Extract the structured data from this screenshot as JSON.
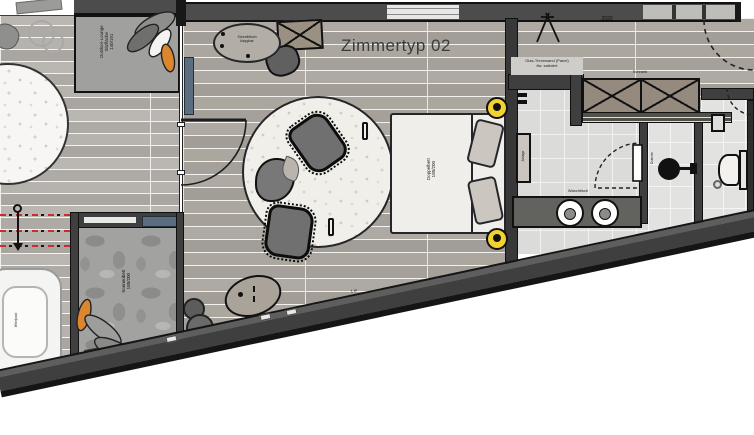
{
  "plan": {
    "title": "Zimmertyp 02",
    "labels": {
      "outdoor_lounge": [
        "Outdoor-Lounge",
        "Sitzfläche",
        "140/191"
      ],
      "sun_bed": [
        "Sonnenbett",
        "180/200"
      ],
      "whirlpool": "Whirlpool",
      "bed": [
        "Doppelbett",
        "180/200"
      ],
      "desk": [
        "Schreibtisch",
        "klappbar"
      ],
      "washbasin": "Waschtisch",
      "shelf": "Ablage",
      "shower": "Dusche",
      "wardrobe": "Schrank",
      "glass_note": [
        "Glas-Trennwand (Panel)",
        "tlw. satiniert"
      ],
      "dimension_top": "2020",
      "scale_note": "1 m"
    },
    "colors": {
      "wall_dark": "#3f3f3f",
      "accent_orange": "#dd8630",
      "lamp_yellow": "#f2d231",
      "glass_blue": "#5c6d7f",
      "section_red": "#c43026",
      "rug": "#f1efe9"
    }
  }
}
